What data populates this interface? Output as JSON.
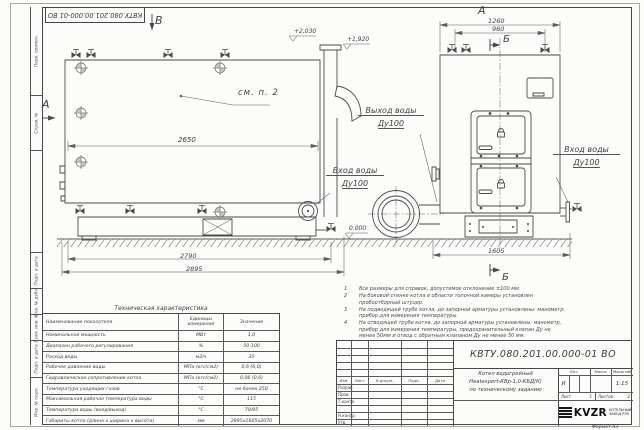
{
  "doc": {
    "number": "КВТУ.080.201.00.000-01 ВО",
    "format": "Формат  А3"
  },
  "frame_labels": [
    "Перв. примен.",
    "Справ. №",
    "",
    "Подп. и дата",
    "Инв. № дубл.",
    "Взам. инв. №",
    "Подп. и дата",
    "Инв. № подл."
  ],
  "annotations": {
    "view_b": "В",
    "view_a": "А",
    "front_a": "А",
    "section_b_top": "Б",
    "section_b_bottom": "Б",
    "see_note": "см. п. 2",
    "dim_2650": "2650",
    "dim_2790": "2790",
    "dim_2895": "2895",
    "dim_1260": "1260",
    "dim_960": "960",
    "dim_1605": "1605",
    "elev_top": "+2,030",
    "elev_mid": "+1,920",
    "elev_zero": "0.000",
    "water_inlet": "Вход воды",
    "water_outlet": "Выход воды",
    "dn100": "Ду100"
  },
  "tech_table": {
    "title": "Техническая характеристика",
    "headers": [
      "Наименование показателя",
      "Единицы измерения",
      "Значение"
    ],
    "rows": [
      [
        "Номинальная мощность",
        "МВт",
        "1,0"
      ],
      [
        "Диапазон рабочего регулирования",
        "%",
        "50-100"
      ],
      [
        "Расход воды",
        "м3/ч",
        "35"
      ],
      [
        "Рабочее давление воды",
        "МПа (кгс/см2)",
        "0,6 (6,0)"
      ],
      [
        "Гидравлическое сопротивление котла",
        "МПа (кгс/см2)",
        "0,06 (0,6)"
      ],
      [
        "Температура уходящих газов",
        "°С",
        "не более 250"
      ],
      [
        "Максимальная рабочая температура воды",
        "°С",
        "115"
      ],
      [
        "Температура воды (вход/выход)",
        "°С",
        "70/95"
      ],
      [
        "Габариты котла (длина х ширина х высота)",
        "мм",
        "2895х1605х2070"
      ]
    ]
  },
  "notes": {
    "items": [
      {
        "num": "1",
        "text": "Все размеры для справок, допустимое отклонение ±100 мм."
      },
      {
        "num": "2",
        "text": "На боковой стенке котла в области топочной камеры установлен пробоотборный штуцер."
      },
      {
        "num": "3",
        "text": "На подводящей трубе котла, до запорной арматуры установлены: манометр, прибор для измерения температуры."
      },
      {
        "num": "4",
        "text": "На отводящей трубе котла, до запорной арматуры установлены: манометр, прибор для измерения температуры, предохранительный клапан Ду не менее 50мм и отвод с обратным клапаном Ду не менее 50 мм."
      }
    ]
  },
  "stamp": {
    "cols": [
      "Изм.",
      "Лист",
      "N докум.",
      "Подп.",
      "Дата"
    ],
    "roles": [
      "Разраб.",
      "Пров.",
      "Т.контр.",
      "Н.контр.",
      "Утв."
    ],
    "title": [
      "Котел водогрейный",
      "Heatexpert-КВр-1,0-КБД(К)",
      "по техническому заданию"
    ],
    "lit_header": "Лит.",
    "mass_header": "Масса",
    "scale_header": "Масштаб",
    "lit": "И",
    "scale": "1:15",
    "sheet_label": "Лист",
    "sheet": "1",
    "sheets_label": "Листов",
    "sheets": "2",
    "logo": "KVZR",
    "logo_cap1": "КОТЕЛЬНЫЙ",
    "logo_cap2": "ЗАВОД РЭП"
  }
}
